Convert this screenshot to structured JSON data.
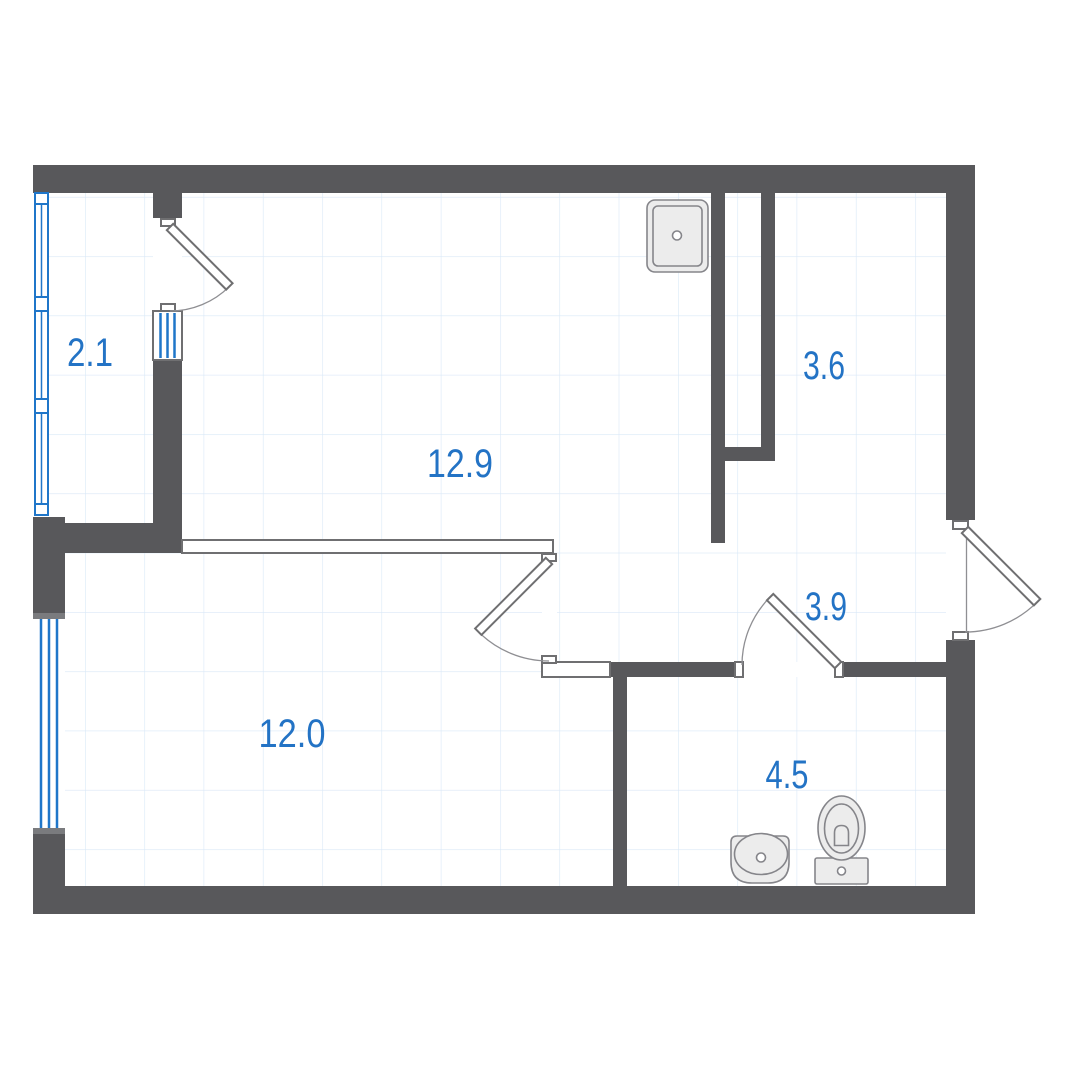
{
  "rooms": [
    {
      "name": "balcony",
      "area": "2.1"
    },
    {
      "name": "living-kitchen",
      "area": "12.9"
    },
    {
      "name": "storage",
      "area": "3.6"
    },
    {
      "name": "hall",
      "area": "3.9"
    },
    {
      "name": "bedroom",
      "area": "12.0"
    },
    {
      "name": "bathroom",
      "area": "4.5"
    }
  ],
  "fixtures": [
    {
      "name": "kitchen-sink"
    },
    {
      "name": "washbasin"
    },
    {
      "name": "toilet"
    }
  ],
  "openings": {
    "doors": [
      "balcony-door",
      "bedroom-door",
      "bathroom-door",
      "entry-door"
    ],
    "windows": [
      "balcony-glazing",
      "bedroom-window",
      "balcony-door-window"
    ]
  },
  "colors": {
    "wall": "#58585b",
    "window_blue": "#1f76c9",
    "label_blue": "#2373c5",
    "grid_line": "#d9e8f7",
    "door_outline": "#6f6f71",
    "fixture_fill": "#ececec",
    "fixture_stroke": "#85858a"
  }
}
